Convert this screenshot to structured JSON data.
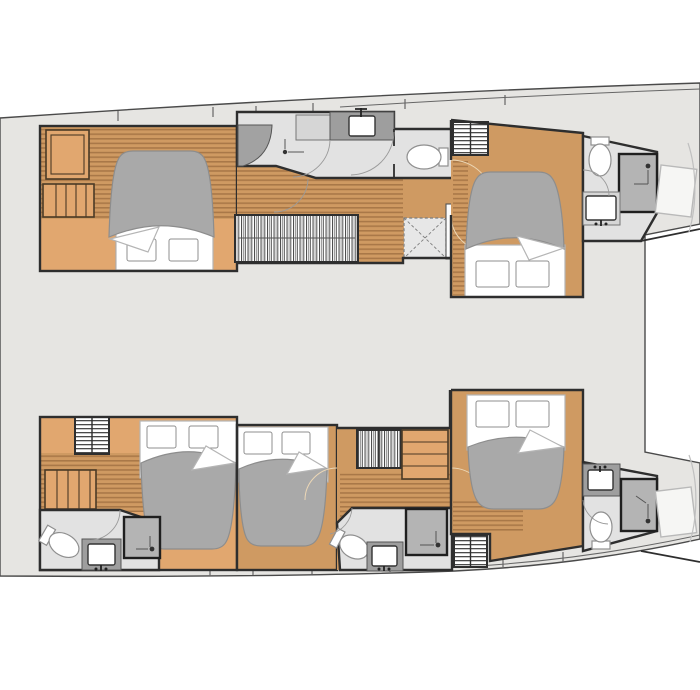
{
  "meta": {
    "description": "Catamaran interior deck plan, top-down view, five cabins",
    "view": "top-down floor plan",
    "vessel_type": "catamaran"
  },
  "palette": {
    "background": "#ffffff",
    "deck": "#e6e5e2",
    "deck_line": "#666666",
    "hull_line": "#4a4a4a",
    "wall": "#2e2e2e",
    "wood": "#cf9a62",
    "wood_light": "#e1a76f",
    "wood_stripe": "#8a5c33",
    "wood_trim": "#4a3a26",
    "bed_gray": "#a9a9a9",
    "bed_edge": "#8d8d8d",
    "linen_edge": "#b5b5b5",
    "fixture_edge": "#8f8f8f",
    "shower": "#b4b4b4",
    "shower_edge": "#1f1f1f",
    "counter": "#9e9e9e",
    "counter_light": "#d6d6d6",
    "bath_floor": "#e2e2e2",
    "hatch_edge": "#7e7e7e",
    "berth": "#f6f6f4",
    "bow_line": "#c0c0c0",
    "arc": "#9a9a9a",
    "arc_wood": "#ecd7b6",
    "metal": "#222222"
  },
  "summary": {
    "cabins": 5,
    "bathrooms": 5,
    "bow_berths": 2,
    "double_beds": 5
  },
  "layout": {
    "hulls": [
      {
        "id": "port",
        "position": "top",
        "rooms": [
          {
            "name": "aft-cabin",
            "fixtures": [
              "double-bed",
              "pillows",
              "vanity-desk",
              "steps",
              "settee",
              "striped-wood-floor"
            ]
          },
          {
            "name": "midship-bathroom",
            "fixtures": [
              "washbasin",
              "counter",
              "toilet",
              "shower-seat",
              "hand-shower"
            ]
          },
          {
            "name": "companionway",
            "fixtures": [
              "hanging-wardrobe",
              "striped-wood-floor",
              "deck-hatch",
              "mast-post"
            ]
          },
          {
            "name": "forward-cabin",
            "fixtures": [
              "double-bed",
              "pillows",
              "louvered-locker",
              "wood-floor"
            ]
          },
          {
            "name": "forward-bathroom",
            "fixtures": [
              "toilet",
              "shower",
              "washbasin"
            ]
          },
          {
            "name": "forepeak",
            "fixtures": [
              "crew-berth"
            ]
          }
        ]
      },
      {
        "id": "starboard",
        "position": "bottom",
        "rooms": [
          {
            "name": "aft-cabin",
            "fixtures": [
              "double-bed",
              "pillows",
              "shelf-locker",
              "steps",
              "striped-wood-floor"
            ]
          },
          {
            "name": "aft-bathroom",
            "fixtures": [
              "toilet",
              "washbasin",
              "shower"
            ]
          },
          {
            "name": "mid-cabin",
            "fixtures": [
              "double-bed",
              "pillows"
            ]
          },
          {
            "name": "companionway",
            "fixtures": [
              "slatted-locker",
              "steps",
              "striped-wood-floor"
            ]
          },
          {
            "name": "mid-bathroom",
            "fixtures": [
              "toilet",
              "washbasin",
              "shower",
              "louvered-locker"
            ]
          },
          {
            "name": "forward-cabin",
            "fixtures": [
              "double-bed",
              "pillows",
              "wood-floor"
            ]
          },
          {
            "name": "forward-bathroom",
            "fixtures": [
              "washbasin",
              "toilet",
              "shower"
            ]
          },
          {
            "name": "forepeak",
            "fixtures": [
              "crew-berth"
            ]
          }
        ]
      }
    ]
  }
}
